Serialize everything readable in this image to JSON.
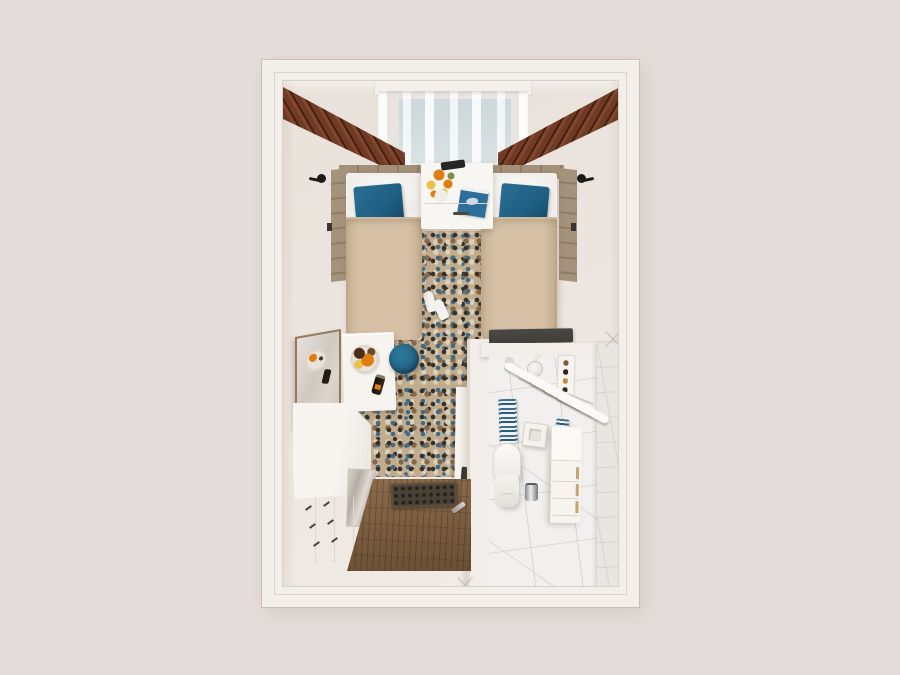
{
  "scene": {
    "type": "3d-floorplan-render",
    "view": "top-down",
    "description": "Twin hotel room rendered from above: two single beds with teal accent pillows flanking a nightstand under a sheer-curtained window, mosaic runner carpet, vanity desk with mirror and breakfast tray, teal stool, wooden entry floor with doormat, and an ensuite marble bathroom with toilet, towel rack, sink and drawer vanity"
  },
  "palette": {
    "bg": "#e4dcda",
    "wall": "#f2eeea",
    "floor": "#ece5df",
    "sheer": "#e7e4df",
    "glass": "#bfd1d9",
    "curtain": "#6e3b26",
    "curtainDark": "#46200f",
    "headboard": "#a39078",
    "duvet": "#d6c1a6",
    "accentTeal": "#1e5e81",
    "carpetBase": "#c2ac8e",
    "carpetDark": "#36302a",
    "carpetBlue": "#3c6b8b",
    "carpetBrown": "#83684c",
    "carpetCream": "#ddd0b6",
    "stool": "#226486",
    "wood": "#6a4f35",
    "mat": "#4a4136",
    "marble": "#f2f0ee",
    "marbleWall": "#e9e5e1",
    "grout": "#d8d4d0",
    "stripe": "#3c6c8e",
    "bench": "#413f3c",
    "black": "#1d1a18",
    "orange": "#df7d12",
    "yellow": "#e9c24a",
    "fruitBrown": "#4b2e1a",
    "bottle": "#221910",
    "book": "#2e6e9a",
    "chrome": "#74787c",
    "tan": "#c8a372"
  },
  "objects": {
    "room": "hotel twin room floor plan",
    "window": "window with sheer curtains",
    "curtain_left": "brown drape (left)",
    "curtain_right": "brown drape (right)",
    "bed_left": "single bed (left)",
    "bed_right": "single bed (right)",
    "pillow_teal": "teal accent pillow",
    "nightstand": "nightstand with flowers and book",
    "flowers": "orange flower bouquet",
    "book": "blue book",
    "remote": "remote control",
    "sconce": "wall sconce",
    "headboard": "upholstered headboard panel",
    "carpet": "mosaic runner carpet",
    "slippers": "pair of slippers",
    "stool": "round teal stool",
    "mirror": "framed vanity mirror",
    "tray": "breakfast tray with fruit plate and bottle",
    "desk": "white vanity desk",
    "minibar": "glass-front minibar cabinet",
    "closet": "closet doors with handles",
    "divider_wall": "partition wall",
    "tv": "wall-mounted TV",
    "bench": "luggage bench",
    "entry_floor": "wooden entry floor",
    "doormat": "perforated doormat",
    "door_handle": "door handle",
    "bathroom": "ensuite marble bathroom",
    "shower": "shower head",
    "ceiling_light": "ceiling light",
    "amenity_rack": "amenity dispenser rack",
    "towel_rack": "rack with white towels",
    "striped_towel": "blue striped towel",
    "sink": "square wash basin",
    "toilet": "toilet",
    "bin": "chrome waste bin",
    "bath_vanity": "bathroom drawer vanity",
    "marble_wall": "marble tiled wall"
  }
}
